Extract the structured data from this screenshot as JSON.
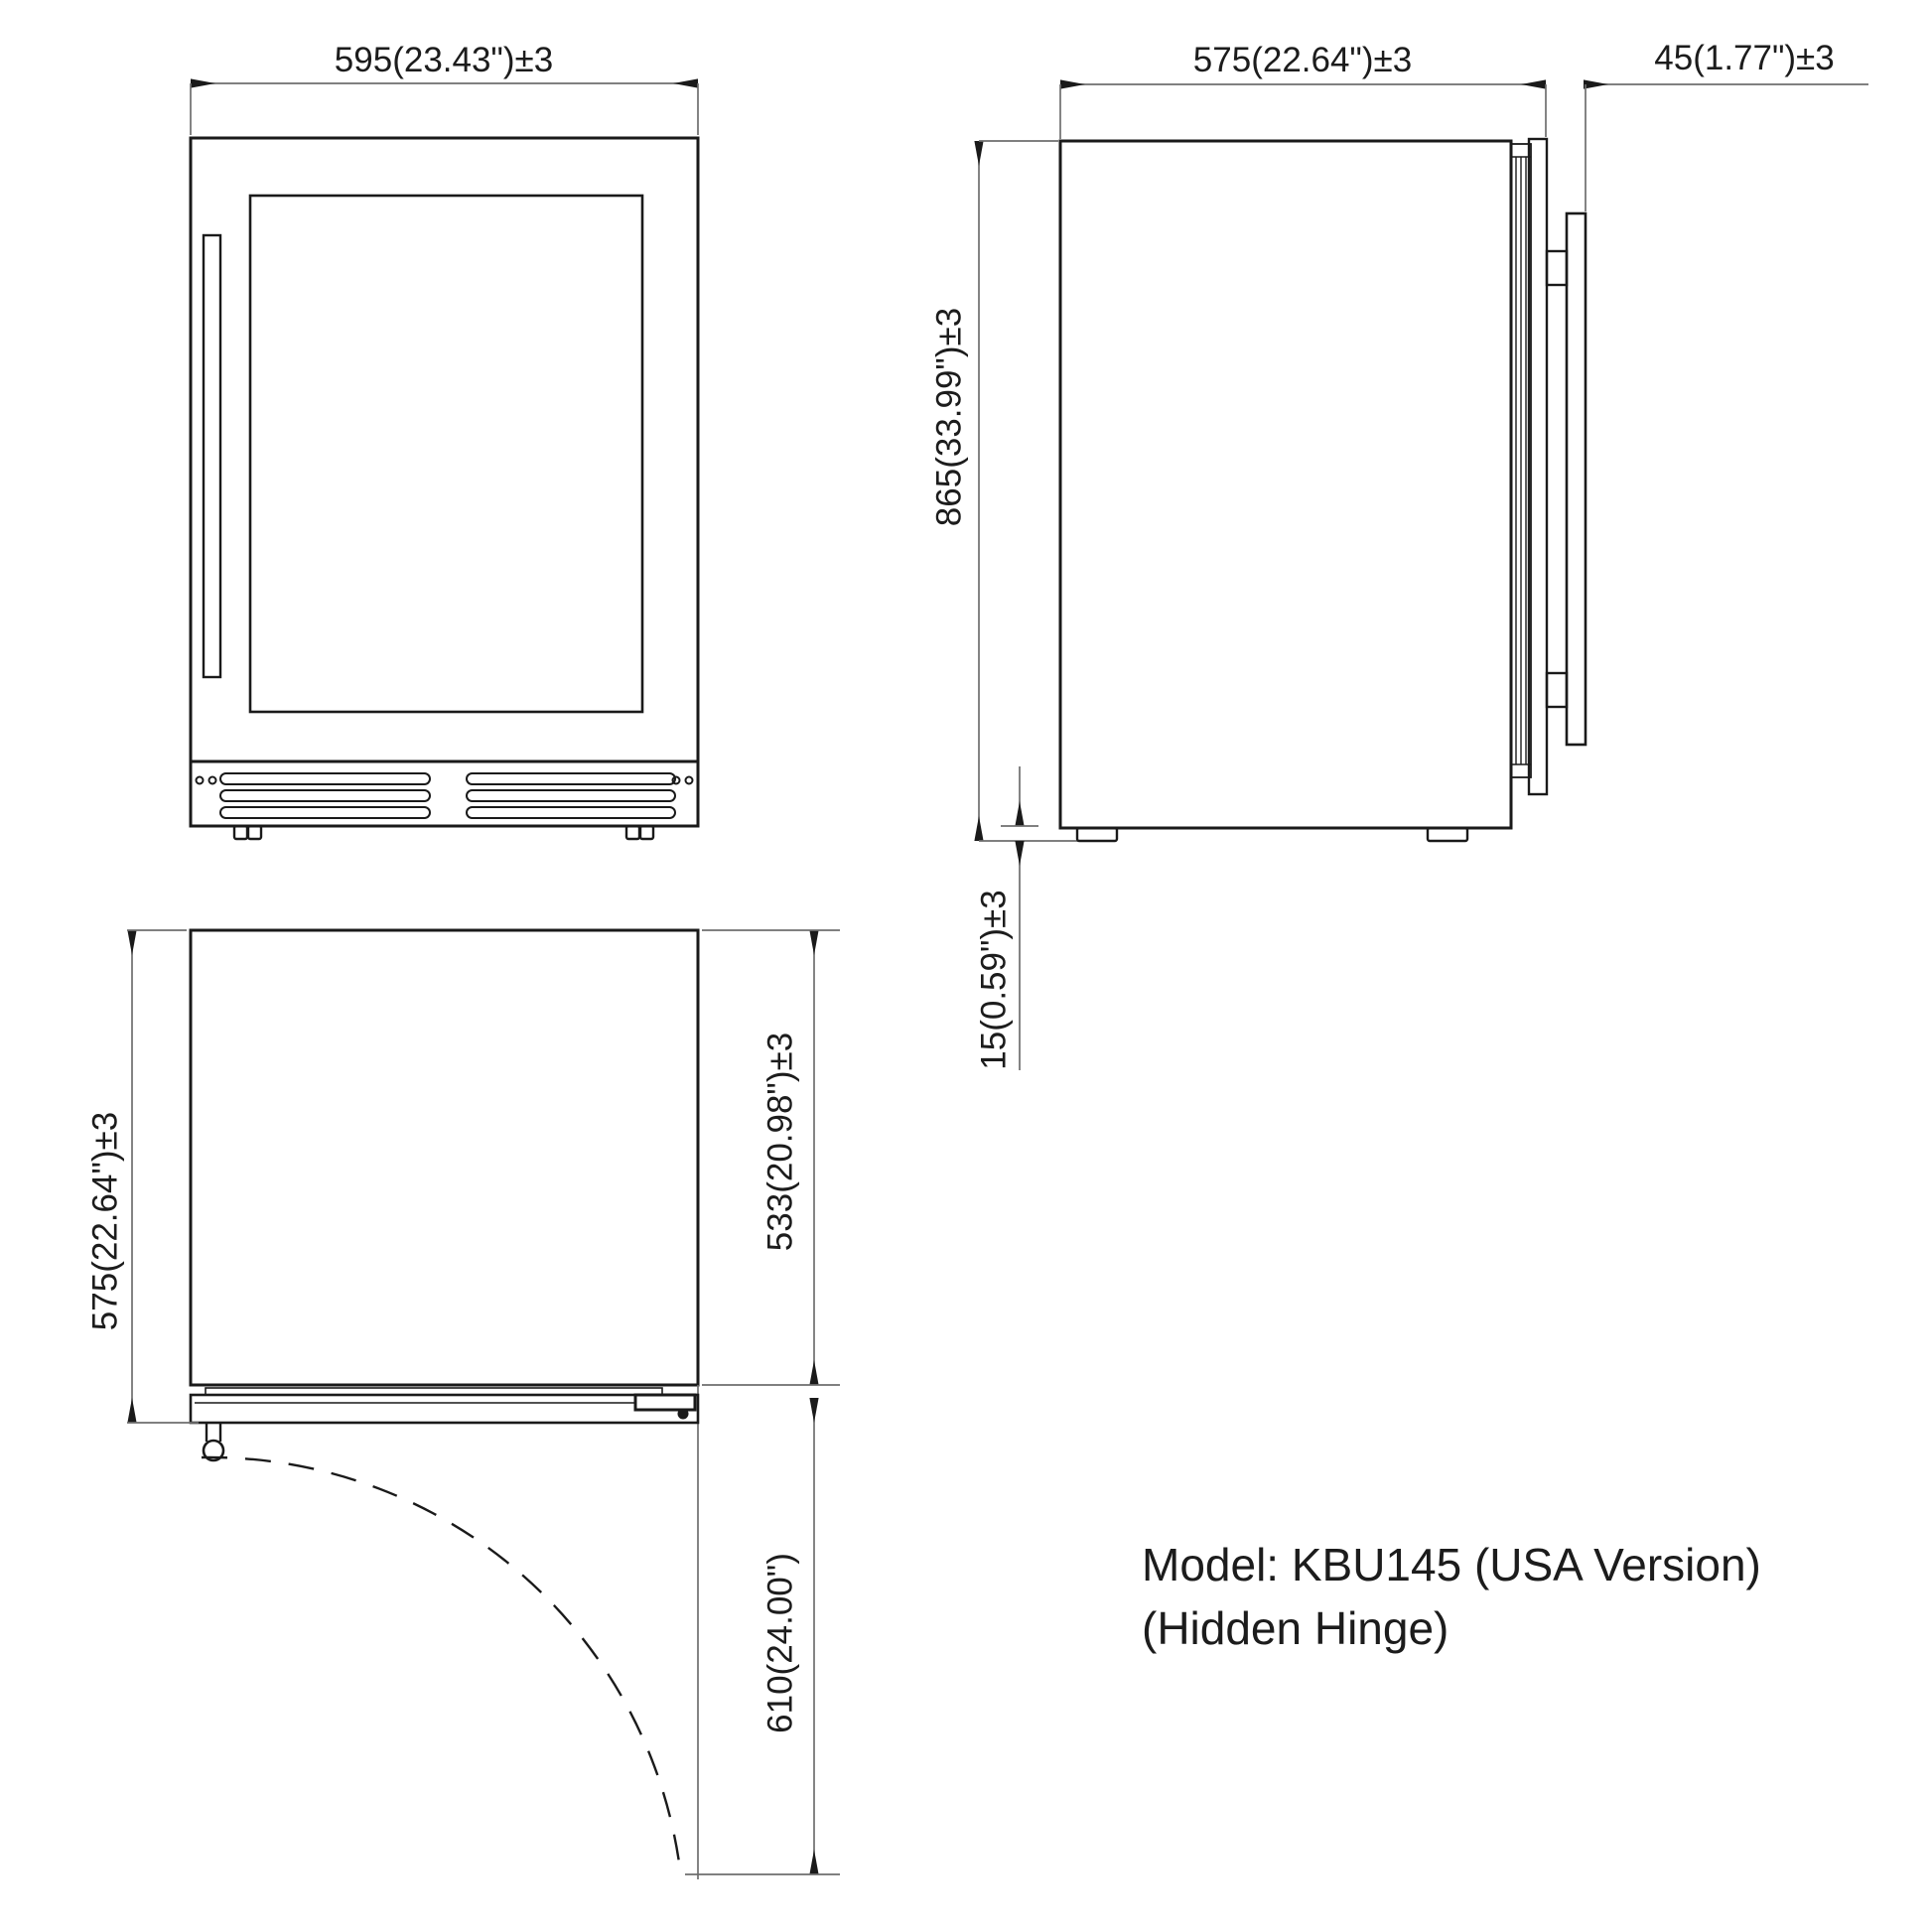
{
  "drawing": {
    "type": "appliance dimension drawing",
    "units": "mm (inches)"
  },
  "front_view": {
    "name": "front-view",
    "width_label": "595(23.43\")±3"
  },
  "side_view": {
    "name": "side-view",
    "depth_label": "575(22.64\")±3",
    "door_thickness_label": "45(1.77\")±3",
    "height_label": "865(33.99\")±3",
    "foot_height_label": "15(0.59\")±3"
  },
  "top_view": {
    "name": "top-view",
    "overall_depth_label": "575(22.64\")±3",
    "cabinet_depth_label": "533(20.98\")±3",
    "door_swing_label": "610(24.00\")"
  },
  "model_info": {
    "line1": "Model: KBU145 (USA Version)",
    "line2": "(Hidden Hinge)"
  },
  "colors": {
    "object_line": "#1a1a1a",
    "dimension_line": "#6e6e6e",
    "background": "#ffffff"
  }
}
